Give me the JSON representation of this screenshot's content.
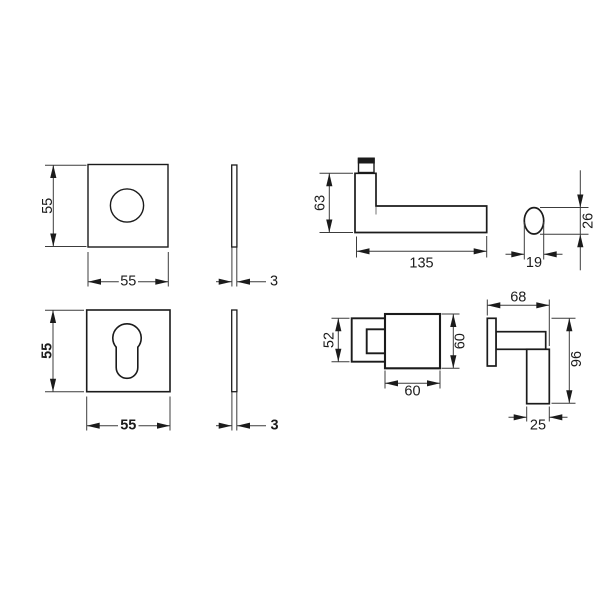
{
  "drawing": {
    "type": "technical dimension drawing",
    "product": "square rose door lever handle set",
    "background_color": "#ffffff",
    "object_line_color": "#1b1b1b",
    "dimension_line_color": "#3c3c3c"
  },
  "views": {
    "rose_front": {
      "height": "55",
      "width": "55"
    },
    "rose_side": {
      "thickness": "3"
    },
    "escutcheon_front": {
      "height": "55",
      "width": "55"
    },
    "escutcheon_side": {
      "thickness": "3"
    },
    "lever_side": {
      "height": "63",
      "length": "135",
      "grip_width": "19",
      "grip_height": "26"
    },
    "lever_front": {
      "neck_height": "52",
      "grip_width": "60",
      "grip_height": "60"
    },
    "lever_top": {
      "projection": "68",
      "depth": "96",
      "grip_thickness": "25"
    }
  }
}
